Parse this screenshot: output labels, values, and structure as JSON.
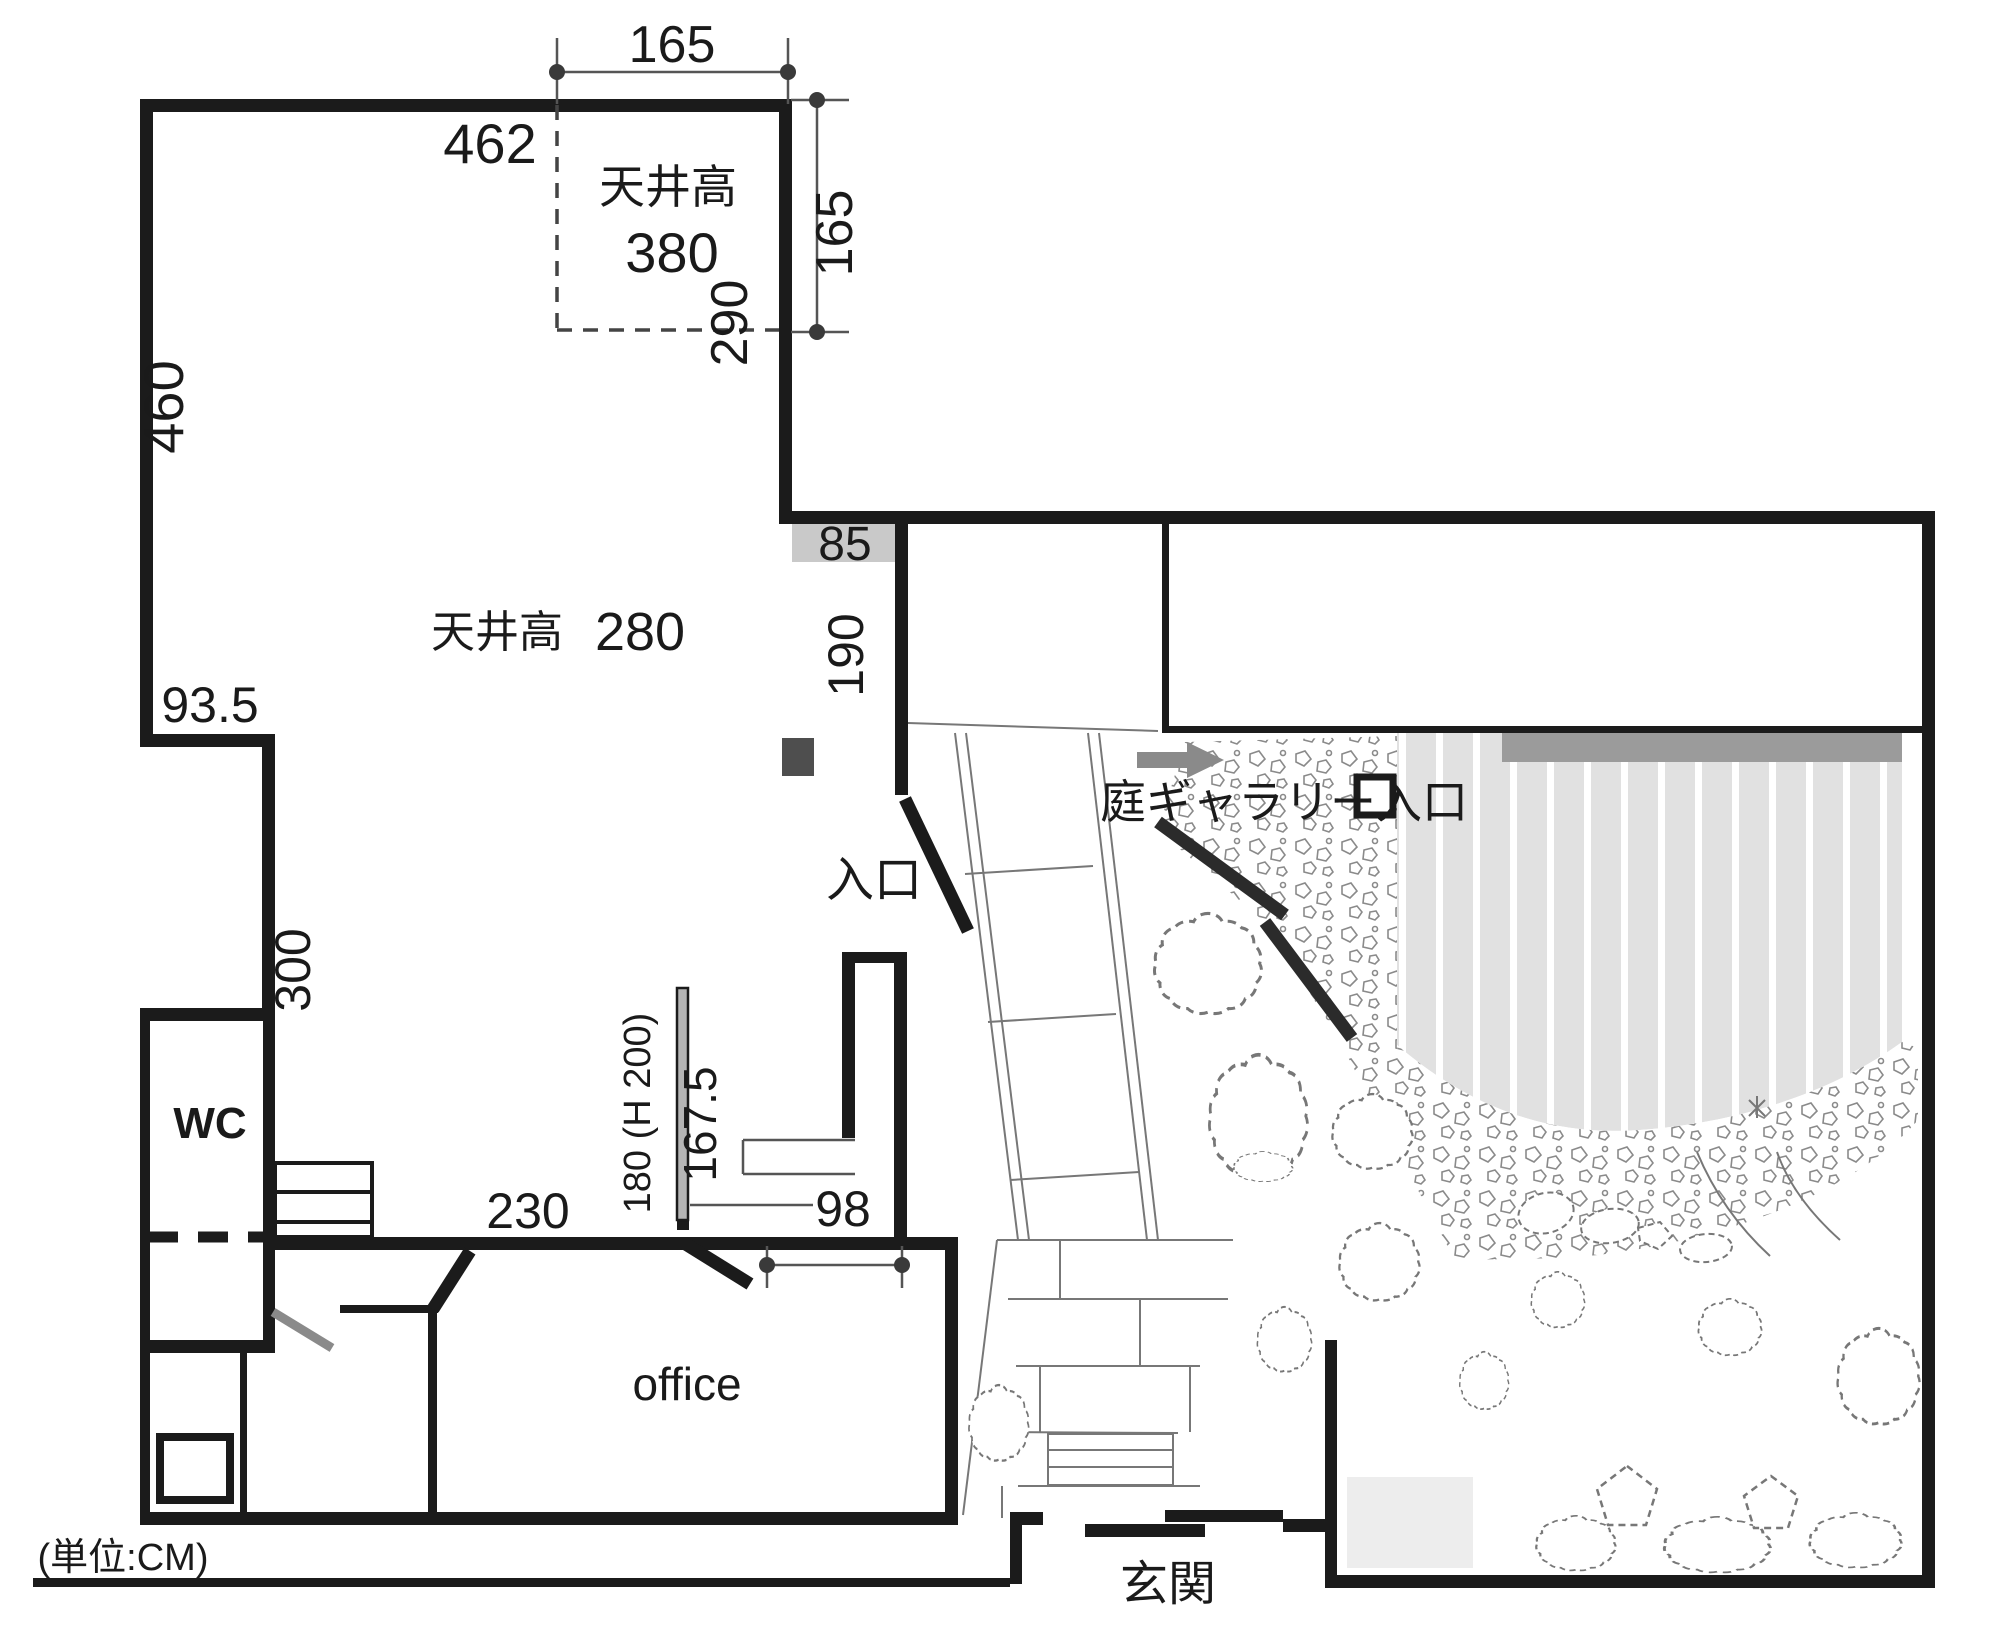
{
  "unit_note": "(単位:CM)",
  "rooms": {
    "upper_corner": {
      "ceiling_label": "天井高",
      "ceiling_value": "380"
    },
    "main_gallery": {
      "ceiling_label": "天井高",
      "ceiling_value": "280"
    },
    "wc": "WC",
    "office": "office",
    "genkan": "玄関"
  },
  "entrances": {
    "main": "入口",
    "garden_gallery": "庭ギャラリー入口"
  },
  "dimensions": {
    "dim_165_top": "165",
    "dim_165_right": "165",
    "dim_290": "290",
    "dim_462": "462",
    "dim_460": "460",
    "dim_935": "93.5",
    "dim_300": "300",
    "dim_85": "85",
    "dim_190": "190",
    "dim_230": "230",
    "dim_180": "180 (H 200)",
    "dim_1675": "167.5",
    "dim_98": "98"
  },
  "colors": {
    "wall": "#1b1b1b",
    "gray_strip": "#c9c9c9",
    "dark_marker": "#4e4e4e",
    "arrow": "#8a8a8a",
    "deck_edge_bar": "#9b9b9b",
    "deck_stripe": "#e1e1e1",
    "light_patch": "#ededed",
    "thin_line": "#777777"
  }
}
